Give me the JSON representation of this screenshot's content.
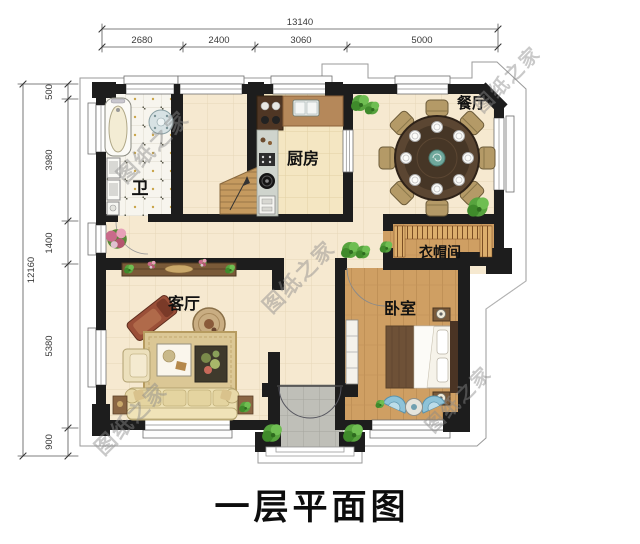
{
  "title": "一层平面图",
  "watermark_text": "图纸之家",
  "dimensions": {
    "top": {
      "total": "13140",
      "segments": [
        "2680",
        "2400",
        "3060",
        "5000"
      ]
    },
    "left": {
      "total": "12160",
      "segments": [
        "500",
        "3980",
        "1400",
        "5380",
        "900"
      ]
    }
  },
  "rooms": {
    "bathroom": "卫",
    "kitchen": "厨房",
    "dining": "餐厅",
    "cloakroom": "衣帽间",
    "bedroom": "卧室",
    "living_room": "客厅"
  },
  "colors": {
    "wall": "#1d1d1d",
    "floor_cream": "#f6e9d0",
    "floor_kitchen": "#f4e6c2",
    "floor_tile": "#f7f5ee",
    "floor_wood": "#cf9f63",
    "porch_stone": "#bfbfb8",
    "plant_green": "#57a33e",
    "dining_table": "#5b4632",
    "sofa": "#ecdfb2"
  }
}
